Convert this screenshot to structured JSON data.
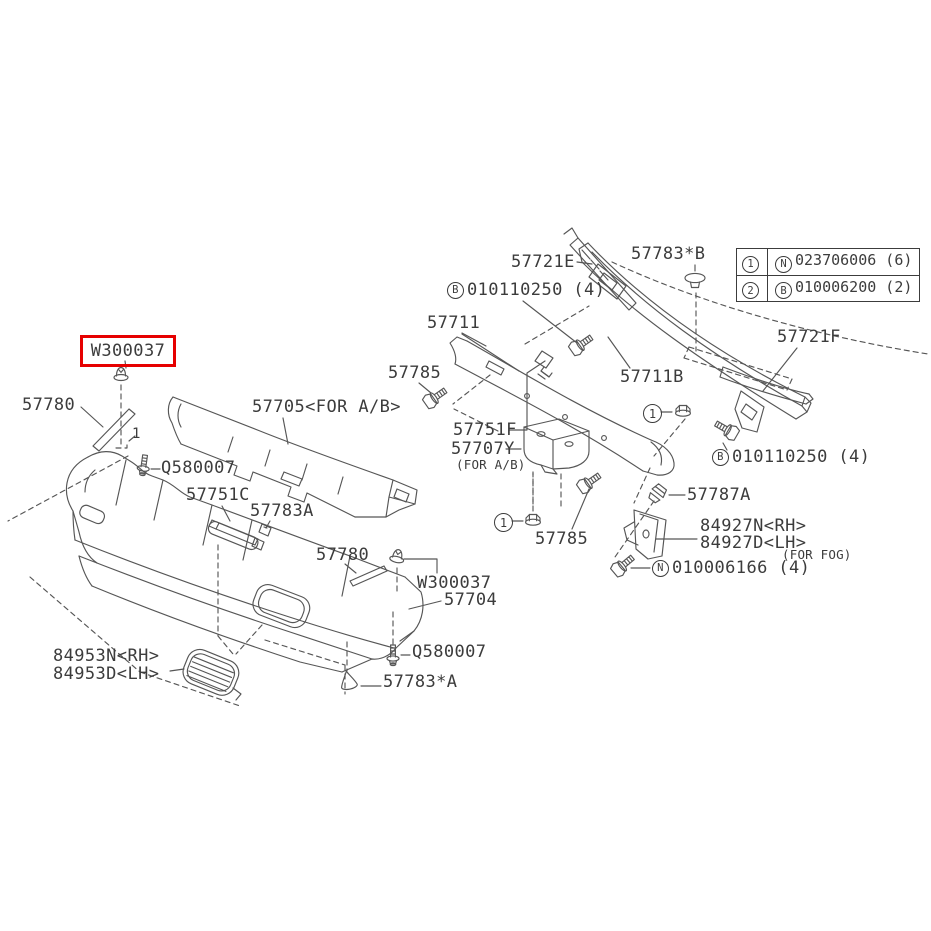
{
  "legend": {
    "rows": [
      {
        "num": "1",
        "letter": "N",
        "part": "023706006 (6)"
      },
      {
        "num": "2",
        "letter": "B",
        "part": "010006200 (2)"
      }
    ]
  },
  "highlight": {
    "color": "#e60000"
  },
  "parts": {
    "p57721e": {
      "text": "57721E"
    },
    "p57783b": {
      "text": "57783*B"
    },
    "b0101_top": {
      "letter": "B",
      "text": "010110250 (4)"
    },
    "p57711": {
      "text": "57711"
    },
    "p57721f": {
      "text": "57721F"
    },
    "p57711b": {
      "text": "57711B"
    },
    "p57785_a": {
      "text": "57785"
    },
    "w300037_a": {
      "text": "W300037"
    },
    "p57780_a": {
      "text": "57780"
    },
    "p57705": {
      "text": "57705<FOR A/B>"
    },
    "q580007_a": {
      "text": "Q580007"
    },
    "p57751c": {
      "text": "57751C"
    },
    "p57783a": {
      "text": "57783A"
    },
    "p57751f": {
      "text": "57751F"
    },
    "p57707y": {
      "text": "57707Y",
      "sub": "(FOR A/B)"
    },
    "b0101_right": {
      "letter": "B",
      "text": "010110250 (4)"
    },
    "p57787a": {
      "text": "57787A"
    },
    "p84927n": {
      "text": "84927N<RH>"
    },
    "p84927d": {
      "text": "84927D<LH>"
    },
    "forfog": {
      "text": "(FOR FOG)"
    },
    "n0100": {
      "letter": "N",
      "text": "010006166 (4)"
    },
    "p57785_b": {
      "text": "57785"
    },
    "p57780_b": {
      "text": "57780"
    },
    "w300037_b": {
      "text": "W300037"
    },
    "p57704": {
      "text": "57704"
    },
    "q580007_b": {
      "text": "Q580007"
    },
    "p57783a_star": {
      "text": "57783*A"
    },
    "p84953n": {
      "text": "84953N<RH>"
    },
    "p84953d": {
      "text": "84953D<LH>"
    },
    "callout1_a": {
      "text": "1"
    },
    "callout1_b": {
      "text": "1"
    },
    "callout1_inline": {
      "text": "1"
    }
  }
}
